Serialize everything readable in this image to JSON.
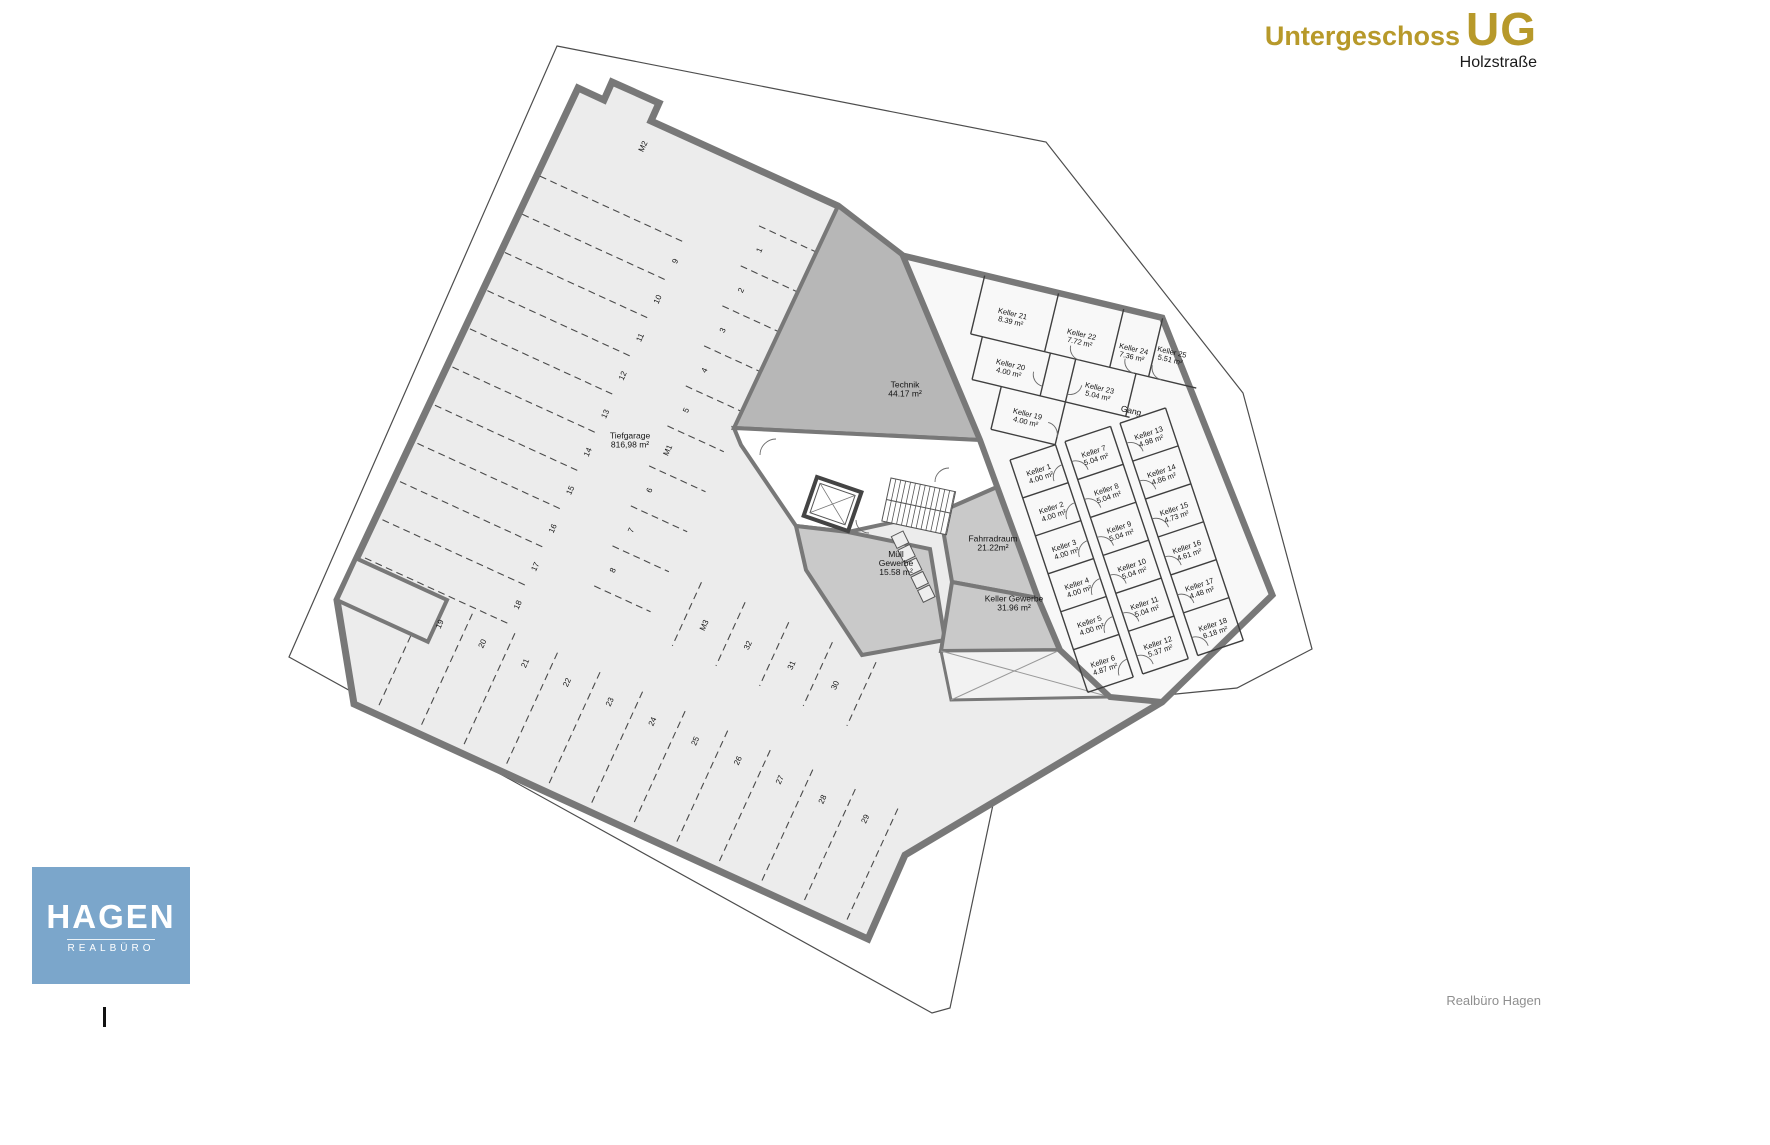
{
  "header": {
    "title": "Untergeschoss",
    "code": "UG",
    "subtitle": "Holzstraße",
    "accent_color": "#b7992a"
  },
  "logo": {
    "name": "HAGEN",
    "sub": "REALBÜRO",
    "bg_color": "#7ba6cb"
  },
  "footer": {
    "credit": "Realbüro Hagen"
  },
  "plan": {
    "cellars": [
      {
        "n": "Keller 1",
        "a": "4.00 m²",
        "l": "B",
        "x": 24,
        "y": 22
      },
      {
        "n": "Keller 2",
        "a": "4.00 m²",
        "l": "B",
        "x": 24,
        "y": 62
      },
      {
        "n": "Keller 3",
        "a": "4.00 m²",
        "l": "B",
        "x": 24,
        "y": 102
      },
      {
        "n": "Keller 4",
        "a": "4.00 m²",
        "l": "B",
        "x": 24,
        "y": 142
      },
      {
        "n": "Keller 5",
        "a": "4.00 m²",
        "l": "B",
        "x": 24,
        "y": 182
      },
      {
        "n": "Keller 6",
        "a": "4.87 m²",
        "l": "B",
        "x": 24,
        "y": 224
      },
      {
        "n": "Keller 7",
        "a": "5.04 m²",
        "l": "B",
        "x": 82,
        "y": 22
      },
      {
        "n": "Keller 8",
        "a": "5.04 m²",
        "l": "B",
        "x": 82,
        "y": 62
      },
      {
        "n": "Keller 9",
        "a": "5.04 m²",
        "l": "B",
        "x": 82,
        "y": 102
      },
      {
        "n": "Keller 10",
        "a": "5.04 m²",
        "l": "B",
        "x": 82,
        "y": 142
      },
      {
        "n": "Keller 11",
        "a": "5.04 m²",
        "l": "B",
        "x": 82,
        "y": 182
      },
      {
        "n": "Keller 12",
        "a": "5.37 m²",
        "l": "B",
        "x": 82,
        "y": 224
      },
      {
        "n": "Keller 13",
        "a": "4.98 m²",
        "l": "B",
        "x": 140,
        "y": 22
      },
      {
        "n": "Keller 14",
        "a": "4.86 m²",
        "l": "B",
        "x": 140,
        "y": 62
      },
      {
        "n": "Keller 15",
        "a": "4.73 m²",
        "l": "B",
        "x": 140,
        "y": 102
      },
      {
        "n": "Keller 16",
        "a": "4.61 m²",
        "l": "B",
        "x": 140,
        "y": 142
      },
      {
        "n": "Keller 17",
        "a": "4.48 m²",
        "l": "B",
        "x": 140,
        "y": 182
      },
      {
        "n": "Keller 18",
        "a": "6.18 m²",
        "l": "B",
        "x": 140,
        "y": 224
      },
      {
        "n": "Keller 19",
        "a": "4.00 m²",
        "l": "A",
        "x": 158,
        "y": 128
      },
      {
        "n": "Keller 20",
        "a": "4.00 m²",
        "l": "A",
        "x": 130,
        "y": 84
      },
      {
        "n": "Keller 21",
        "a": "8.39 m²",
        "l": "A",
        "x": 120,
        "y": 34
      },
      {
        "n": "Keller 22",
        "a": "7.72 m²",
        "l": "A",
        "x": 192,
        "y": 38
      },
      {
        "n": "Keller 23",
        "a": "5.04 m²",
        "l": "A",
        "x": 222,
        "y": 86
      },
      {
        "n": "Keller 24",
        "a": "7.36 m²",
        "l": "A",
        "x": 246,
        "y": 40
      },
      {
        "n": "Keller 25",
        "a": "5.51 m²",
        "l": "A",
        "x": 284,
        "y": 34
      }
    ],
    "rooms": [
      {
        "lines": [
          "Technik",
          "44.17 m²"
        ],
        "layer": "screen",
        "x": 905,
        "y": 392
      },
      {
        "lines": [
          "Müll",
          "Gewerbe",
          "15.58 m²"
        ],
        "layer": "screen",
        "x": 896,
        "y": 566
      },
      {
        "lines": [
          "Fahrradraum",
          "21.22m²"
        ],
        "layer": "screen",
        "x": 993,
        "y": 546
      },
      {
        "lines": [
          "Keller Gewerbe",
          "31.96 m²"
        ],
        "layer": "screen",
        "x": 1014,
        "y": 606
      },
      {
        "lines": [
          "Tiefgarage",
          "816,98 m²"
        ],
        "layer": "screen",
        "x": 630,
        "y": 443
      },
      {
        "lines": [
          "Gang"
        ],
        "layer": "A",
        "x": 258,
        "y": 100
      }
    ],
    "parking": [
      {
        "n": "M2",
        "u": 86,
        "v": 26
      },
      {
        "n": "9",
        "u": 163,
        "v": 117
      },
      {
        "n": "10",
        "u": 163,
        "v": 159
      },
      {
        "n": "11",
        "u": 163,
        "v": 201
      },
      {
        "n": "12",
        "u": 163,
        "v": 243
      },
      {
        "n": "13",
        "u": 163,
        "v": 285
      },
      {
        "n": "14",
        "u": 163,
        "v": 327
      },
      {
        "n": "15",
        "u": 163,
        "v": 369
      },
      {
        "n": "16",
        "u": 163,
        "v": 411
      },
      {
        "n": "17",
        "u": 163,
        "v": 453
      },
      {
        "n": "18",
        "u": 163,
        "v": 495
      },
      {
        "n": "1",
        "u": 235,
        "v": 72
      },
      {
        "n": "2",
        "u": 235,
        "v": 116
      },
      {
        "n": "3",
        "u": 235,
        "v": 160
      },
      {
        "n": "4",
        "u": 235,
        "v": 204
      },
      {
        "n": "5",
        "u": 235,
        "v": 248
      },
      {
        "n": "M1",
        "u": 235,
        "v": 292
      },
      {
        "n": "6",
        "u": 235,
        "v": 336
      },
      {
        "n": "7",
        "u": 235,
        "v": 380
      },
      {
        "n": "8",
        "u": 235,
        "v": 424
      },
      {
        "n": "19",
        "u": 100,
        "v": 545
      },
      {
        "n": "20",
        "u": 147,
        "v": 545
      },
      {
        "n": "21",
        "u": 194,
        "v": 545
      },
      {
        "n": "22",
        "u": 240,
        "v": 545
      },
      {
        "n": "23",
        "u": 287,
        "v": 545
      },
      {
        "n": "24",
        "u": 334,
        "v": 545
      },
      {
        "n": "25",
        "u": 381,
        "v": 545
      },
      {
        "n": "26",
        "u": 428,
        "v": 545
      },
      {
        "n": "27",
        "u": 474,
        "v": 545
      },
      {
        "n": "28",
        "u": 521,
        "v": 545
      },
      {
        "n": "29",
        "u": 568,
        "v": 545
      },
      {
        "n": "M3",
        "u": 341,
        "v": 436
      },
      {
        "n": "32",
        "u": 389,
        "v": 436
      },
      {
        "n": "31",
        "u": 437,
        "v": 436
      },
      {
        "n": "30",
        "u": 485,
        "v": 436
      }
    ]
  }
}
